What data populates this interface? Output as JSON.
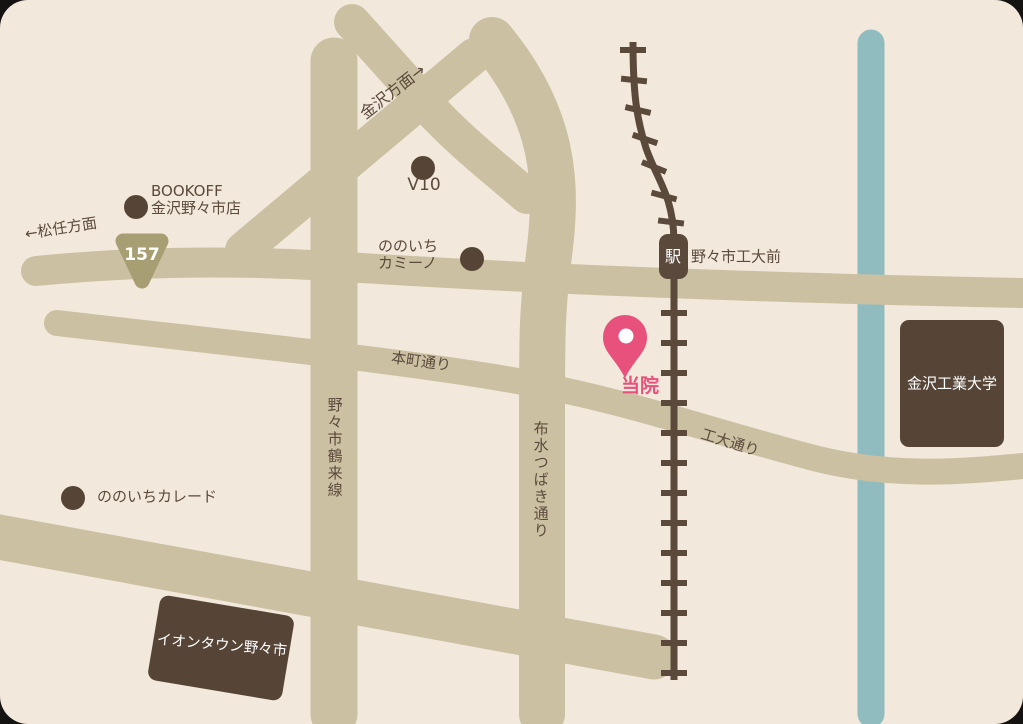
{
  "colors": {
    "backdrop": "#151312",
    "page_bg": "#f2e8dc",
    "road": "#cbc1a2",
    "route_shield": "#a89e73",
    "rail_brown": "#5b4a3c",
    "building_brown": "#564537",
    "label_brown": "#5b4a3c",
    "clinic_pink": "#e8517b",
    "river_blue": "#90bcc0",
    "white": "#ffffff"
  },
  "map": {
    "directions": {
      "kanazawa": "金沢方面→",
      "matto": "←松任方面"
    },
    "roads": {
      "route_number": "157",
      "honmachi": "本町通り",
      "kodai": "工大通り",
      "tsurugi": "野々市鶴来線",
      "fusui_tsubaki": "布水つばき通り"
    },
    "railway": {
      "station_symbol": "駅",
      "station_name": "野々市工大前"
    },
    "pois": {
      "bookoff_line1": "BOOKOFF",
      "bookoff_line2": "金沢野々市店",
      "v10": "V10",
      "camino_line1": "ののいち",
      "camino_line2": "カミーノ",
      "curade": "ののいちカレード"
    },
    "buildings": {
      "kit_university": "金沢工業大学",
      "aeon_town": "イオンタウン野々市"
    },
    "clinic": {
      "label": "当院"
    }
  }
}
